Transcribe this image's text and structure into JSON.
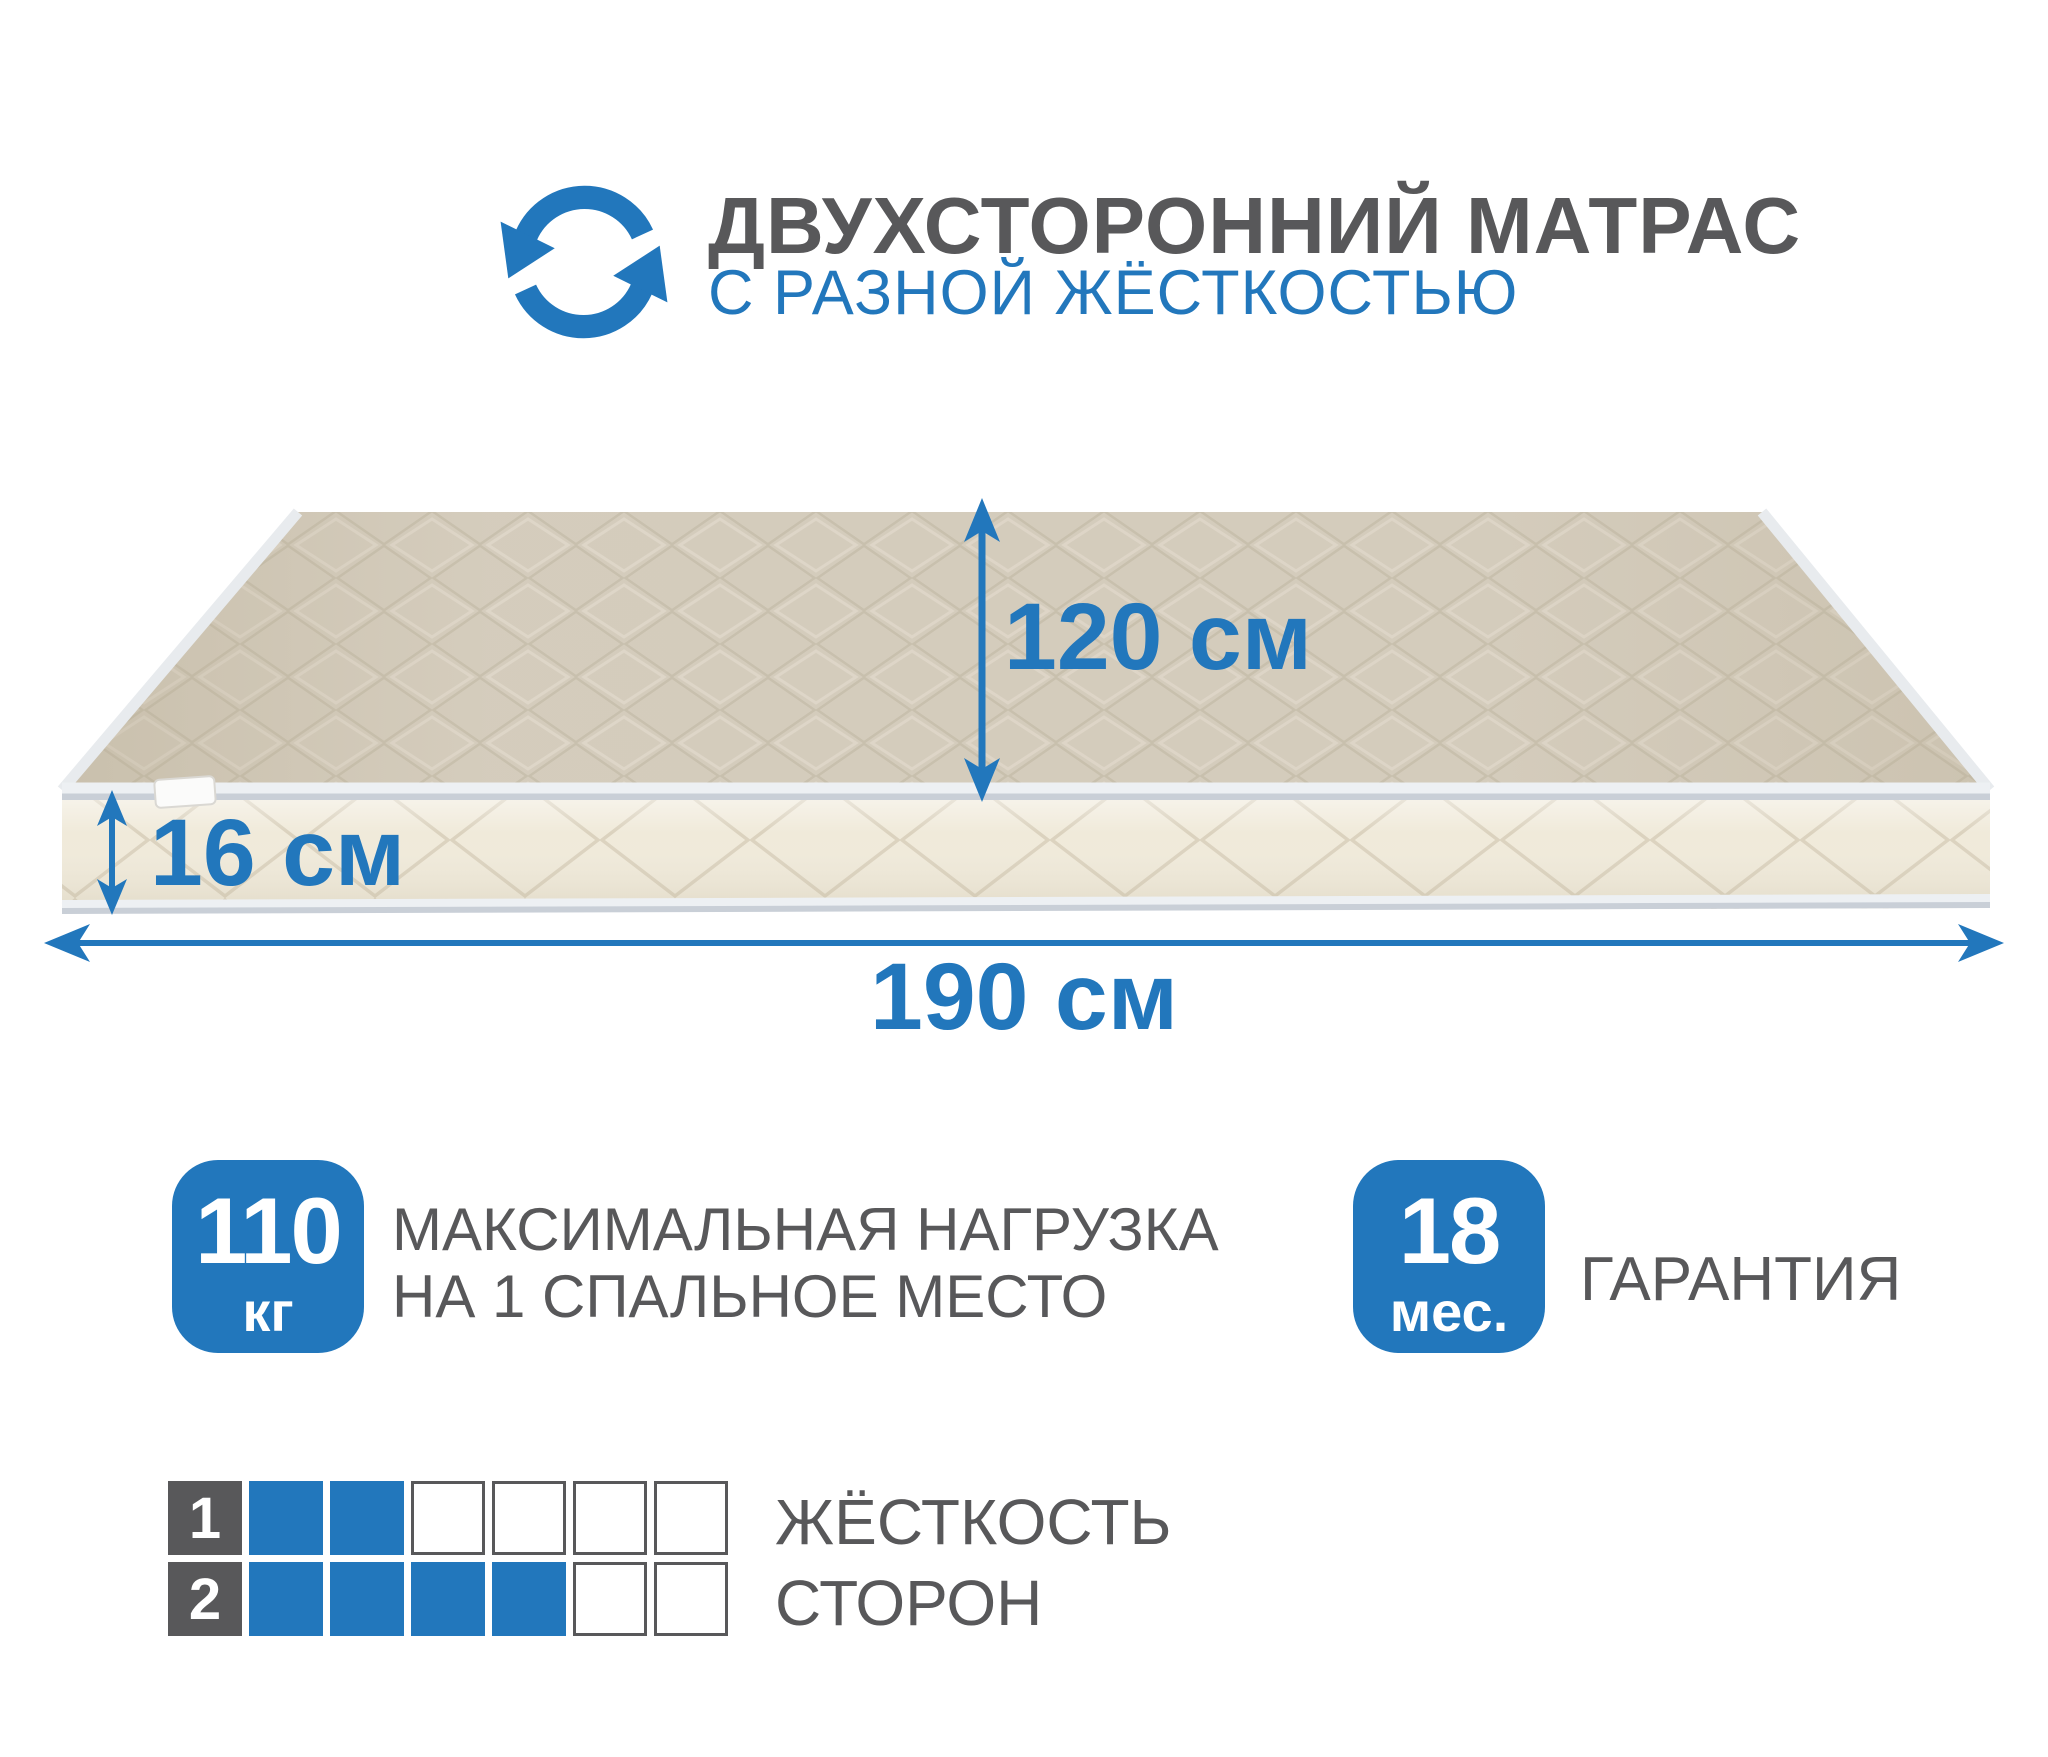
{
  "colors": {
    "accent": "#2277bc",
    "text": "#58585a",
    "mattress_top": "#d7cfc0",
    "mattress_front": "#f0eada",
    "piping": "#edf0f3",
    "piping_shadow": "#c9cfd7",
    "cell_border": "#58585a",
    "label_square": "#58585a"
  },
  "header": {
    "title": "ДВУХСТОРОННИЙ МАТРАС",
    "subtitle": "С РАЗНОЙ ЖЁСТКОСТЬЮ",
    "icon": "rotate-arrows-icon"
  },
  "dimensions": {
    "depth": "120 см",
    "height": "16 см",
    "length": "190 см"
  },
  "max_load": {
    "value": "110",
    "unit": "кг",
    "line1": "МАКСИМАЛЬНАЯ НАГРУЗКА",
    "line2": "НА 1 СПАЛЬНОЕ МЕСТО"
  },
  "warranty": {
    "value": "18",
    "unit": "мес.",
    "label": "ГАРАНТИЯ"
  },
  "firmness": {
    "label_line1": "ЖЁСТКОСТЬ",
    "label_line2": "СТОРОН",
    "scale_max": 6,
    "rows": [
      {
        "num": "1",
        "filled": 2
      },
      {
        "num": "2",
        "filled": 4
      }
    ]
  }
}
